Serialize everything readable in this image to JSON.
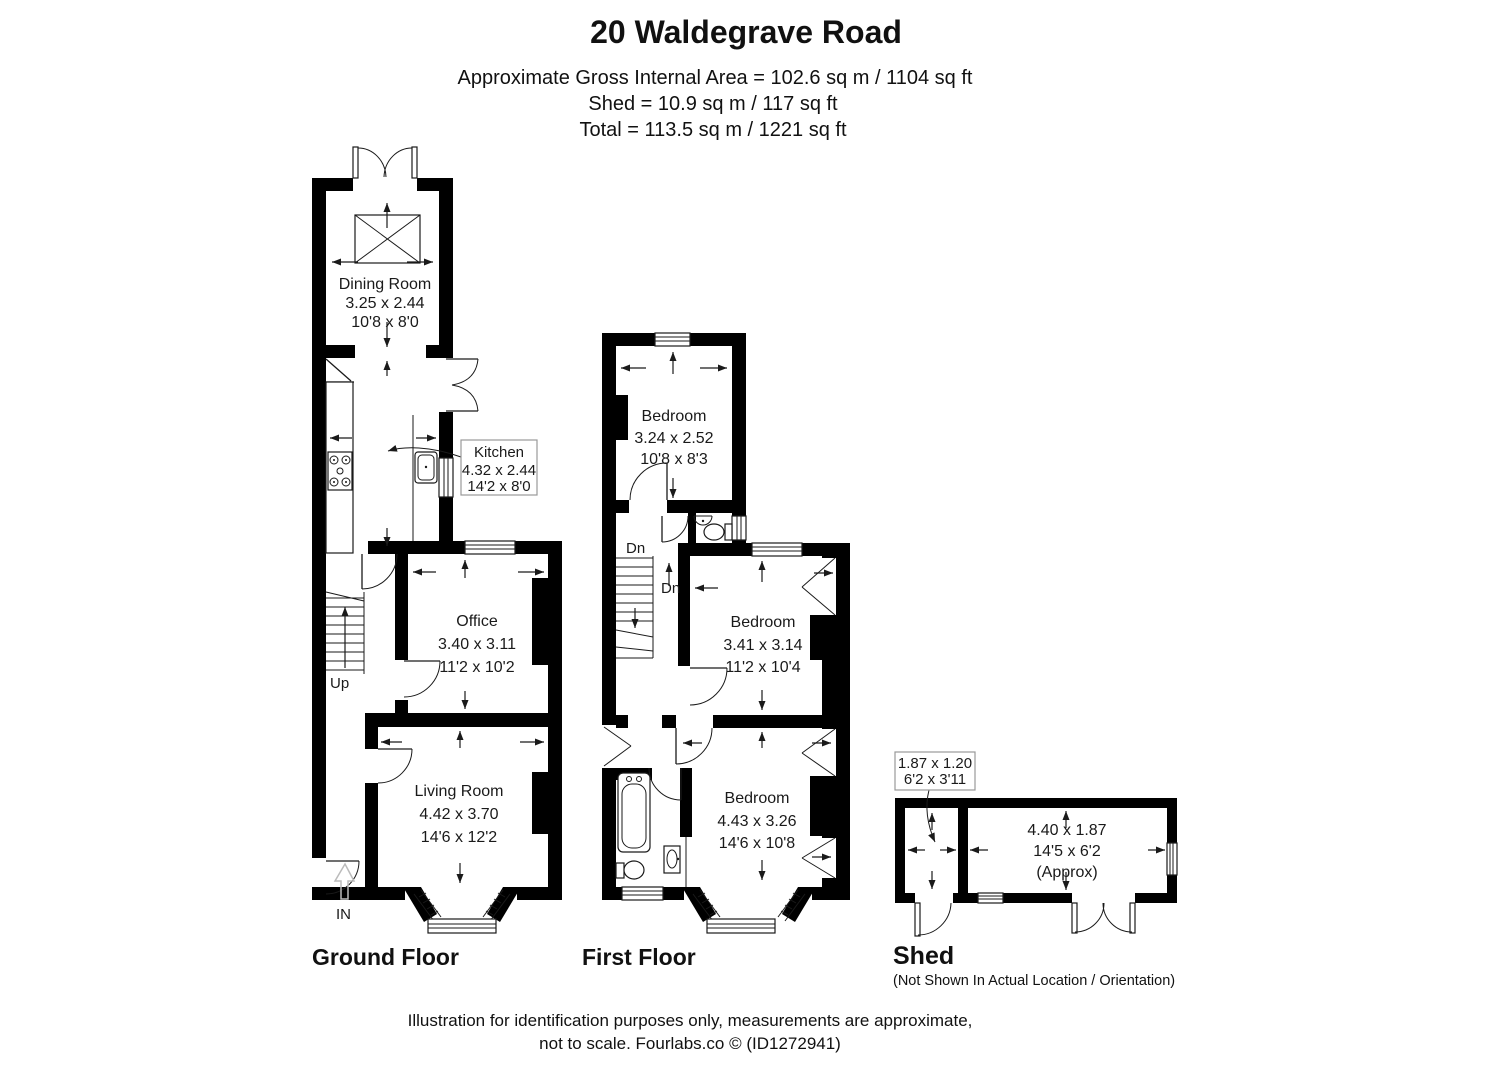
{
  "header": {
    "title": "20 Waldegrave Road",
    "subtitle_lines": [
      "Approximate Gross Internal Area = 102.6 sq m / 1104 sq ft",
      "Shed = 10.9 sq m / 117 sq ft",
      "Total = 113.5 sq m / 1221 sq ft"
    ]
  },
  "ground_floor": {
    "label": "Ground Floor",
    "dining_room": {
      "name": "Dining Room",
      "metric": "3.25 x 2.44",
      "imperial": "10'8 x 8'0"
    },
    "kitchen": {
      "name": "Kitchen",
      "metric": "4.32 x 2.44",
      "imperial": "14'2 x 8'0"
    },
    "office": {
      "name": "Office",
      "metric": "3.40 x 3.11",
      "imperial": "11'2 x 10'2"
    },
    "living_room": {
      "name": "Living Room",
      "metric": "4.42 x 3.70",
      "imperial": "14'6 x 12'2"
    },
    "stairs_label": "Up",
    "entrance_label": "IN"
  },
  "first_floor": {
    "label": "First Floor",
    "bedroom_top": {
      "name": "Bedroom",
      "metric": "3.24 x 2.52",
      "imperial": "10'8 x 8'3"
    },
    "bedroom_middle": {
      "name": "Bedroom",
      "metric": "3.41 x 3.14",
      "imperial": "11'2 x 10'4"
    },
    "bedroom_bottom": {
      "name": "Bedroom",
      "metric": "4.43 x 3.26",
      "imperial": "14'6 x 10'8"
    },
    "stairs_label_upper": "Dn",
    "stairs_label_lower": "Dn"
  },
  "shed": {
    "label": "Shed",
    "note": "(Not Shown In Actual Location / Orientation)",
    "store": {
      "metric": "1.87 x 1.20",
      "imperial": "6'2 x 3'11"
    },
    "main_room": {
      "metric": "4.40 x 1.87",
      "imperial": "14'5 x 6'2",
      "qualifier": "(Approx)"
    }
  },
  "footer": {
    "lines": [
      "Illustration for identification purposes only, measurements are approximate,",
      "not to scale. Fourlabs.co © (ID1272941)"
    ]
  },
  "colors": {
    "wall": "#000000",
    "line": "#1a1a1a",
    "background": "#ffffff",
    "callout_border": "#999999",
    "entry_arrow": "#bbbbbb"
  }
}
